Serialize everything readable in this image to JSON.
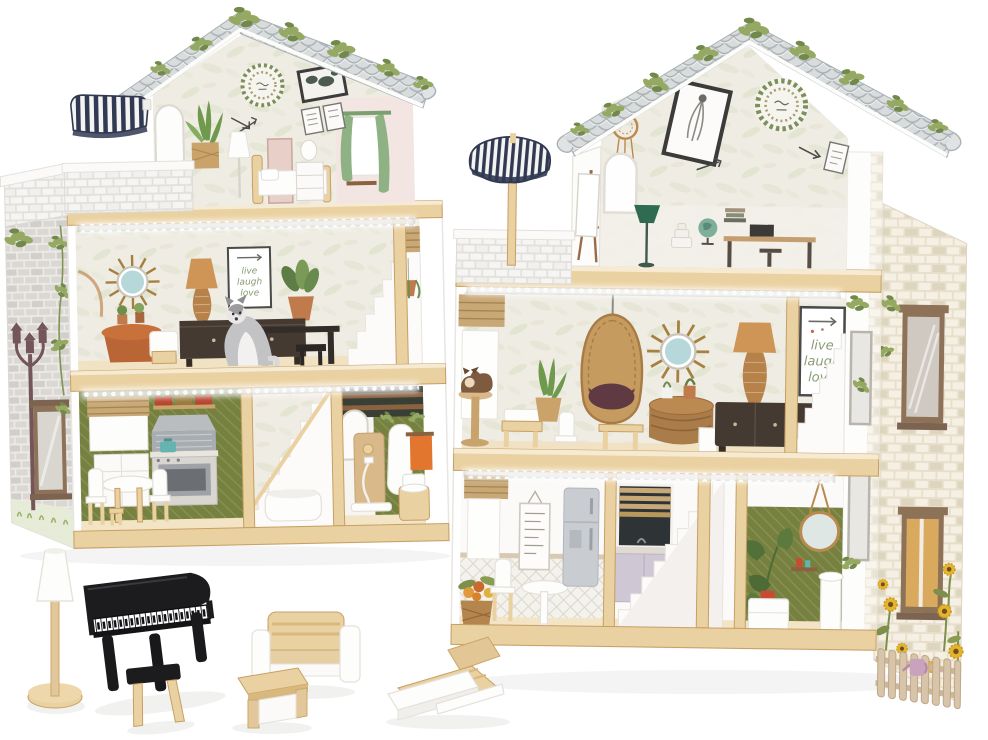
{
  "page": {
    "background": "#ffffff",
    "description": "Product photo of a wooden dollhouse with LED strip lighting shown from two angles, plus wooden toy furniture: floor lamp, black grand piano with stool, sofa, coffee table and sun lounger."
  },
  "texts": {
    "poster": [
      "live",
      "laugh",
      "love"
    ]
  },
  "houses": {
    "left_view": {
      "floors": [
        "attic bedroom with balcony and navy striped awning",
        "living room with LED strip, sunburst mirror, poster and husky figure",
        "kitchen, white staircase and bathroom with shower"
      ]
    },
    "right_view": {
      "floors": [
        "attic studio with easel, balcony and navy striped parasol",
        "study wall with desk, globe and green lamp",
        "living room with hanging egg chair, LED strip and poster",
        "dining room, kitchen, staircase and green bathroom; sunflower side wall with picket fence"
      ]
    }
  },
  "accessories": [
    "floor lamp",
    "grand piano",
    "piano stool",
    "sofa",
    "coffee table",
    "sun lounger"
  ],
  "colors": {
    "pageBg": "#ffffff",
    "wood": "#ead1a1",
    "woodDark": "#d9b87e",
    "woodEdge": "#c79f63",
    "roofBase": "#d8dcdd",
    "roofLine": "#aab1b4",
    "ivy": "#96a962",
    "ivyDark": "#71894a",
    "navy": "#313a52",
    "wallBg": "#efece3",
    "feather": "#dde2cb",
    "pinkWall": "#f3e6e2",
    "greenWall": "#76813f",
    "terracotta": "#c07b4c",
    "darkFurn": "#453a31",
    "pianoBlack": "#1c1c1e",
    "posterGreen": "#8a9c74",
    "posterFrame": "#4a4a48",
    "curtain": "#8fb284",
    "blind": "#c9a878",
    "steel": "#a8adb2",
    "teal": "#66b4b0",
    "orange": "#e2762e",
    "red": "#c94b33",
    "brickGray": "#dbd8d4",
    "brickGrayBg": "#edebe9",
    "brickCream": "#f5f0e3",
    "brickCreamBg": "#e7dfcc",
    "mirrorBlue": "#b7d8da",
    "rattan": "#c08a52",
    "cushion": "#5f3a42",
    "grass": "#9db36a",
    "sunflower": "#e6b32e"
  }
}
